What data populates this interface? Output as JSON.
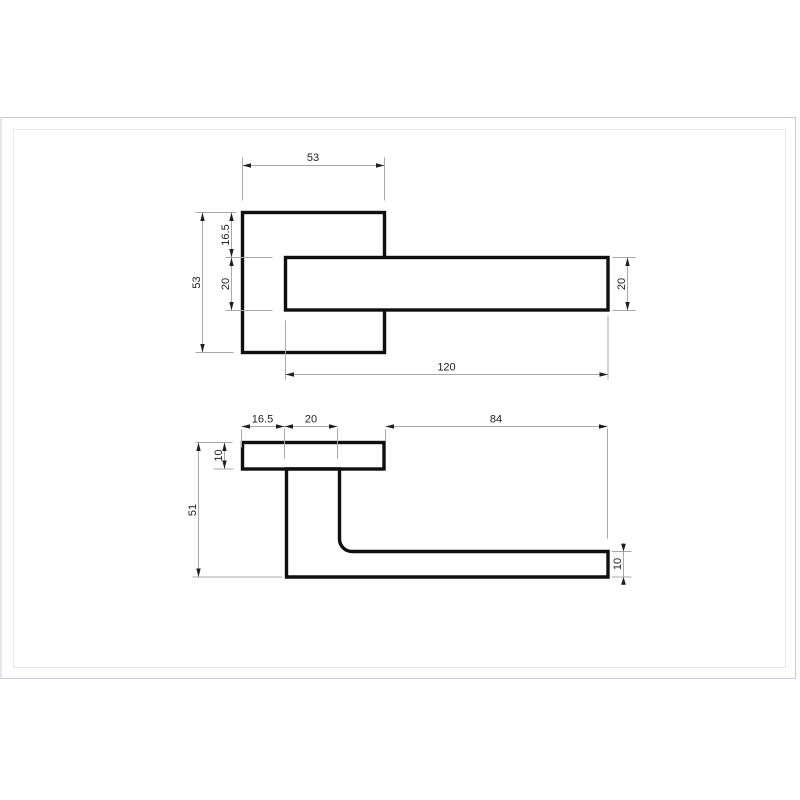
{
  "figure": {
    "type": "technical-drawing",
    "subject": "door lever handle on square rose, two orthographic views with dimensions (mm)",
    "views": {
      "front": {
        "dims": {
          "rose_width": "53",
          "rose_height": "53",
          "lever_offset_top": "16.5",
          "lever_thickness": "20",
          "lever_thickness_right": "20",
          "lever_length": "120"
        }
      },
      "side": {
        "dims": {
          "rose_edge_to_neck": "16.5",
          "neck_width": "20",
          "grip_reach": "84",
          "rose_depth": "10",
          "total_projection": "51",
          "grip_depth": "10"
        }
      }
    },
    "colors": {
      "object_line": "#0f0f0f",
      "dimension_line": "#a8a8a8",
      "arrowhead": "#1f1f1f",
      "label_text": "#222222",
      "frame_outer": "#c9c7e4",
      "frame_inner": "#e8e8e8",
      "background": "#ffffff"
    }
  }
}
